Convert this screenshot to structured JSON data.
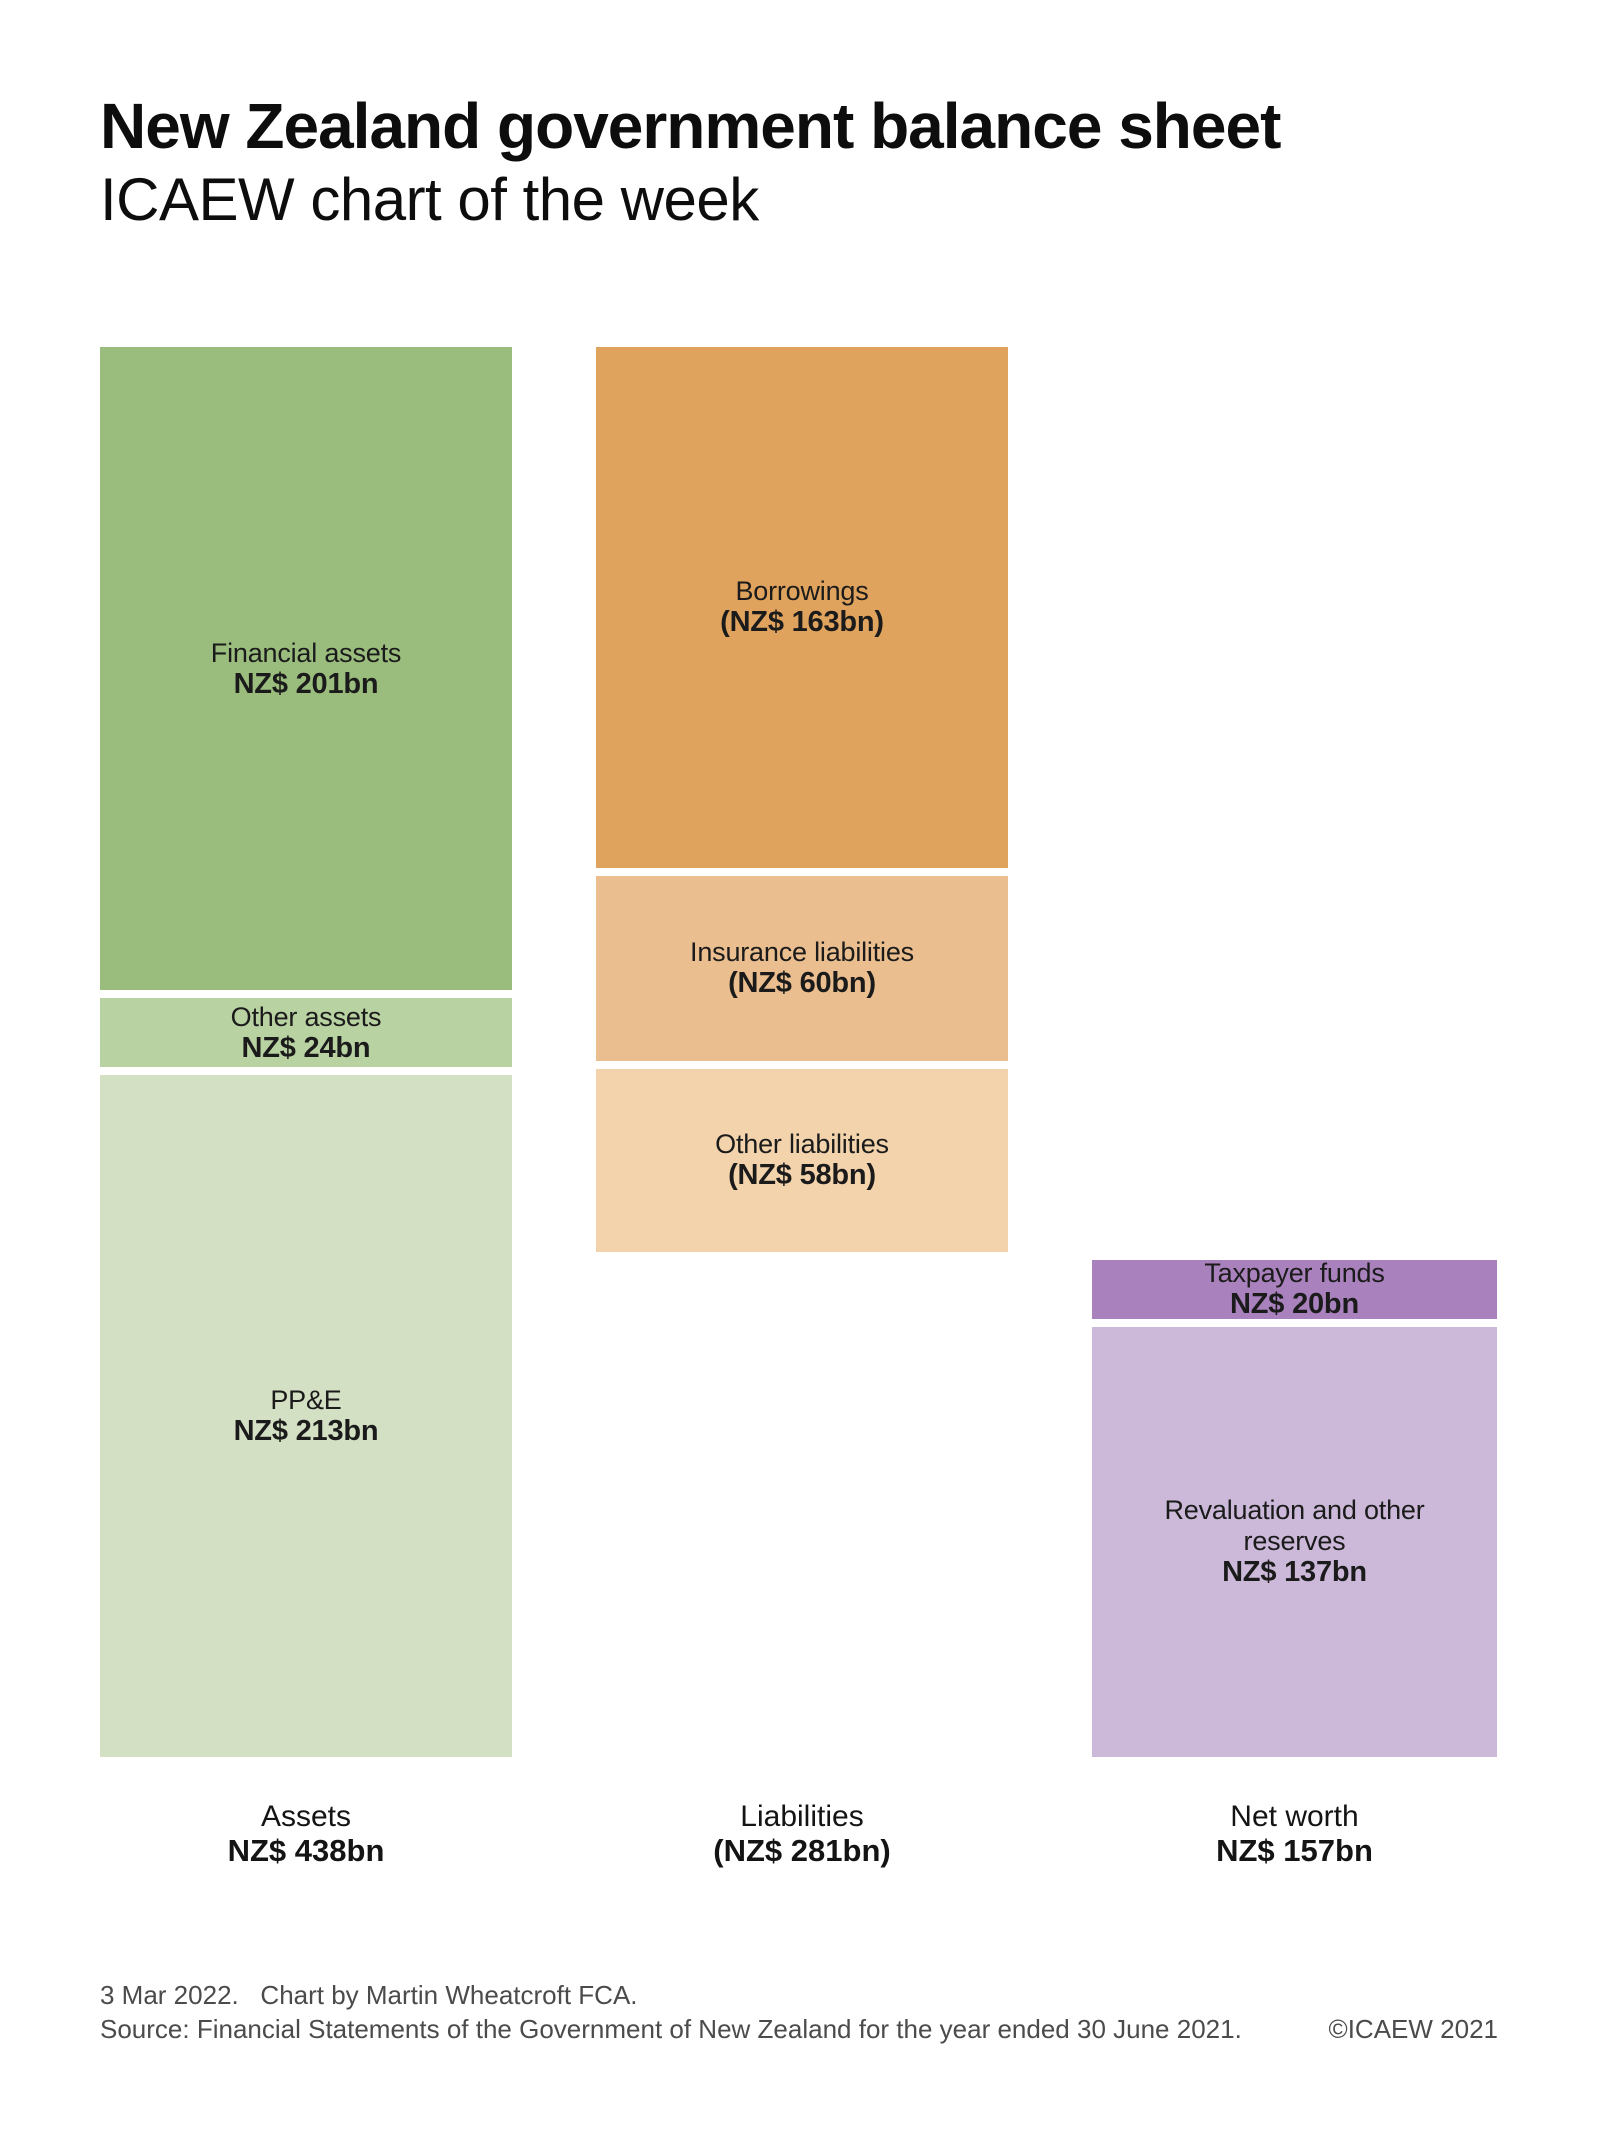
{
  "title": "New Zealand government balance sheet",
  "subtitle": "ICAEW chart of the week",
  "footer": {
    "line1": "3 Mar 2022.   Chart by Martin Wheatcroft FCA.",
    "source": "Source: Financial Statements of the Government of New Zealand for the year ended 30 June 2021.",
    "copyright": "©ICAEW 2021"
  },
  "colors": {
    "background": "#ffffff",
    "text": "#0d0d0d",
    "footer_text": "#4b4b4d",
    "asset_dark_green": "#9abd7e",
    "asset_mid_green": "#b9d2a2",
    "asset_light_green": "#d4e0c3",
    "liability_dark_orange": "#e0a35e",
    "liability_mid_orange": "#eabe8e",
    "liability_light_orange": "#f2d3ab",
    "networth_dark_purple": "#a981bc",
    "networth_light_purple": "#ccb9d9"
  },
  "chart_data": {
    "type": "bar",
    "subtype": "stacked-waterfall-balance-sheet",
    "unit": "NZ$ billion",
    "title": "New Zealand government balance sheet",
    "legend_position": "none",
    "grid": false,
    "columns": [
      {
        "name": "Assets",
        "total": 438,
        "total_label": "NZ$ 438bn",
        "starts_at_bn": 0,
        "segments": [
          {
            "label": "Financial assets",
            "value": 201,
            "value_label": "NZ$ 201bn",
            "color": "#9abd7e"
          },
          {
            "label": "Other assets",
            "value": 24,
            "value_label": "NZ$ 24bn",
            "color": "#b9d2a2"
          },
          {
            "label": "PP&E",
            "value": 213,
            "value_label": "NZ$ 213bn",
            "color": "#d4e0c3"
          }
        ]
      },
      {
        "name": "Liabilities",
        "total": 281,
        "total_label": "(NZ$ 281bn)",
        "starts_at_bn": 0,
        "segments": [
          {
            "label": "Borrowings",
            "value": 163,
            "value_label": "(NZ$ 163bn)",
            "color": "#e0a35e"
          },
          {
            "label": "Insurance liabilities",
            "value": 60,
            "value_label": "(NZ$ 60bn)",
            "color": "#eabe8e"
          },
          {
            "label": "Other liabilities",
            "value": 58,
            "value_label": "(NZ$ 58bn)",
            "color": "#f2d3ab"
          }
        ]
      },
      {
        "name": "Net worth",
        "total": 157,
        "total_label": "NZ$ 157bn",
        "starts_at_bn": 281,
        "segments": [
          {
            "label": "Taxpayer funds",
            "value": 20,
            "value_label": "NZ$ 20bn",
            "color": "#a981bc"
          },
          {
            "label": "Revaluation and other reserves",
            "value": 137,
            "value_label": "NZ$ 137bn",
            "color": "#ccb9d9"
          }
        ]
      }
    ]
  }
}
